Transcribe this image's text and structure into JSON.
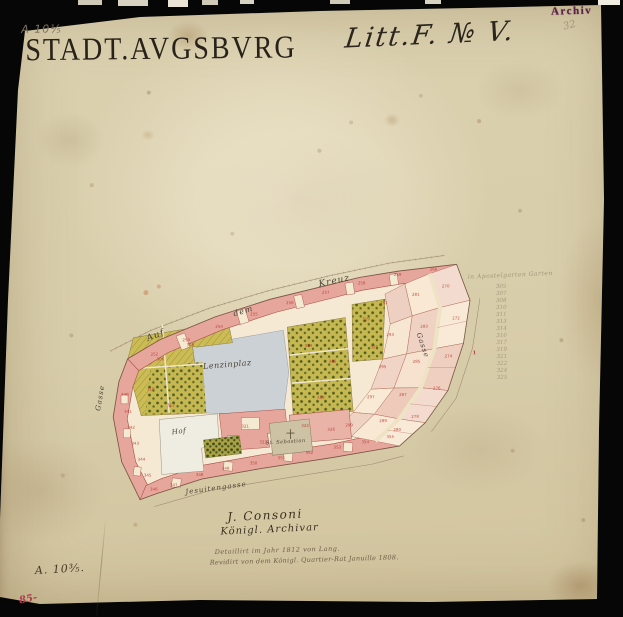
{
  "header": {
    "pencil_ref": "A 10⅕",
    "title": "STADT.AVGSBVRG",
    "litt": "Litt.F. № V.",
    "archive_stamp": "Archiv",
    "pencil_note": "32"
  },
  "footer": {
    "signature": "J. Consoni",
    "signature_title": "Königl. Archivar",
    "note_line1": "Detaillirt im Jahr 1812 von Lang.",
    "note_line2": "Revidirt von dem Königl. Quartier-Rat Januille 1808.",
    "ink_ref": "A. 10⅗.",
    "red_ref": "85-"
  },
  "colors": {
    "paper": "#dbd1b0",
    "ink": "#29221a",
    "stamp": "#5a2048",
    "building_pink": "#e7a69c",
    "building_outline": "#a85048",
    "platz_gray": "#cbd1d5",
    "garden_yellow": "#c6b750",
    "tree_green": "#4c5e22",
    "parcel_number_red": "#b83228",
    "pencil": "#94886e",
    "red_crayon": "#b43a50"
  },
  "map": {
    "pencil_list": {
      "heading": "in Apostelgarten Garten",
      "values": [
        "305",
        "307",
        "308",
        "310",
        "311",
        "313",
        "314",
        "316",
        "317",
        "319",
        "321",
        "322",
        "324",
        "325"
      ]
    },
    "label_groups": [
      {
        "cls": "street-label",
        "name": "street-label",
        "items": [
          {
            "t": "Auf",
            "x": 145,
            "y": 333,
            "r": -21,
            "s": 9
          },
          {
            "t": "dem",
            "x": 232,
            "y": 309,
            "r": -16,
            "s": 8
          },
          {
            "t": "Kreuz",
            "x": 318,
            "y": 280,
            "r": -11,
            "s": 9
          },
          {
            "t": "Gasse",
            "x": 93,
            "y": 408,
            "r": -80,
            "s": 7
          },
          {
            "t": "Gasse",
            "x": 422,
            "y": 333,
            "r": 72,
            "s": 7
          },
          {
            "t": "Jesuitengasse",
            "x": 183,
            "y": 487,
            "r": -7,
            "s": 7
          }
        ]
      },
      {
        "cls": "area-label",
        "name": "area-label",
        "items": [
          {
            "t": "Lenzinplaz",
            "x": 202,
            "y": 361,
            "r": -4,
            "s": 8
          },
          {
            "t": "Hof",
            "x": 170,
            "y": 427,
            "r": -6,
            "s": 7
          },
          {
            "t": "St. Sebastian",
            "x": 264,
            "y": 440,
            "r": -3,
            "s": 5
          }
        ]
      },
      {
        "cls": "parcel-num",
        "name": "parcel-number",
        "items": [
          {
            "t": "252",
            "x": 150,
            "y": 350,
            "s": 4
          },
          {
            "t": "253",
            "x": 182,
            "y": 336,
            "s": 4
          },
          {
            "t": "254",
            "x": 215,
            "y": 323,
            "s": 4
          },
          {
            "t": "255",
            "x": 250,
            "y": 311,
            "s": 4
          },
          {
            "t": "256",
            "x": 286,
            "y": 300,
            "s": 4
          },
          {
            "t": "257",
            "x": 322,
            "y": 290,
            "s": 4
          },
          {
            "t": "258",
            "x": 358,
            "y": 281,
            "s": 4
          },
          {
            "t": "259",
            "x": 394,
            "y": 273,
            "s": 4
          },
          {
            "t": "260",
            "x": 430,
            "y": 268,
            "s": 4
          },
          {
            "t": "340",
            "x": 120,
            "y": 390,
            "s": 4
          },
          {
            "t": "341",
            "x": 123,
            "y": 407,
            "s": 4
          },
          {
            "t": "342",
            "x": 126,
            "y": 423,
            "s": 4
          },
          {
            "t": "343",
            "x": 130,
            "y": 439,
            "s": 4
          },
          {
            "t": "344",
            "x": 136,
            "y": 455,
            "s": 4
          },
          {
            "t": "345",
            "x": 142,
            "y": 471,
            "s": 4
          },
          {
            "t": "346",
            "x": 148,
            "y": 485,
            "s": 4
          },
          {
            "t": "347",
            "x": 168,
            "y": 481,
            "s": 4
          },
          {
            "t": "348",
            "x": 194,
            "y": 471,
            "s": 4
          },
          {
            "t": "349",
            "x": 220,
            "y": 465,
            "s": 4
          },
          {
            "t": "350",
            "x": 248,
            "y": 460,
            "s": 4
          },
          {
            "t": "351",
            "x": 276,
            "y": 455,
            "s": 4
          },
          {
            "t": "352",
            "x": 304,
            "y": 450,
            "s": 4
          },
          {
            "t": "353",
            "x": 332,
            "y": 445,
            "s": 4
          },
          {
            "t": "354",
            "x": 360,
            "y": 440,
            "s": 4
          },
          {
            "t": "355",
            "x": 385,
            "y": 435,
            "s": 4
          },
          {
            "t": "270",
            "x": 442,
            "y": 285,
            "s": 4
          },
          {
            "t": "272",
            "x": 452,
            "y": 317,
            "s": 4
          },
          {
            "t": "274",
            "x": 444,
            "y": 355,
            "s": 4
          },
          {
            "t": "276",
            "x": 432,
            "y": 387,
            "s": 4
          },
          {
            "t": "278",
            "x": 410,
            "y": 415,
            "s": 4
          },
          {
            "t": "280",
            "x": 392,
            "y": 428,
            "s": 4
          },
          {
            "t": "281",
            "x": 412,
            "y": 293,
            "s": 4
          },
          {
            "t": "283",
            "x": 420,
            "y": 325,
            "s": 4
          },
          {
            "t": "285",
            "x": 412,
            "y": 360,
            "s": 4
          },
          {
            "t": "287",
            "x": 398,
            "y": 393,
            "s": 4
          },
          {
            "t": "289",
            "x": 378,
            "y": 419,
            "s": 4
          },
          {
            "t": "291",
            "x": 380,
            "y": 301,
            "s": 4
          },
          {
            "t": "293",
            "x": 386,
            "y": 333,
            "s": 4
          },
          {
            "t": "295",
            "x": 378,
            "y": 365,
            "s": 4
          },
          {
            "t": "297",
            "x": 366,
            "y": 395,
            "s": 4
          },
          {
            "t": "299",
            "x": 344,
            "y": 423,
            "s": 4
          },
          {
            "t": "321",
            "x": 240,
            "y": 423,
            "s": 4
          },
          {
            "t": "322",
            "x": 258,
            "y": 439,
            "s": 4
          },
          {
            "t": "324",
            "x": 300,
            "y": 423,
            "s": 4
          },
          {
            "t": "326",
            "x": 326,
            "y": 427,
            "s": 4
          },
          {
            "t": "306",
            "x": 156,
            "y": 355,
            "s": 4
          },
          {
            "t": "308",
            "x": 186,
            "y": 341,
            "s": 4
          },
          {
            "t": "310",
            "x": 146,
            "y": 385,
            "s": 4
          },
          {
            "t": "312",
            "x": 166,
            "y": 401,
            "s": 4
          },
          {
            "t": "314",
            "x": 304,
            "y": 343,
            "s": 4
          },
          {
            "t": "316",
            "x": 328,
            "y": 359,
            "s": 4
          },
          {
            "t": "318",
            "x": 316,
            "y": 395,
            "s": 4
          },
          {
            "t": "319",
            "x": 362,
            "y": 317,
            "s": 4
          },
          {
            "t": "320",
            "x": 370,
            "y": 345,
            "s": 4
          }
        ]
      },
      {
        "cls": "red-mark",
        "name": "red-mark",
        "items": [
          {
            "t": "1",
            "x": 472,
            "y": 352,
            "s": 5
          }
        ]
      }
    ]
  }
}
